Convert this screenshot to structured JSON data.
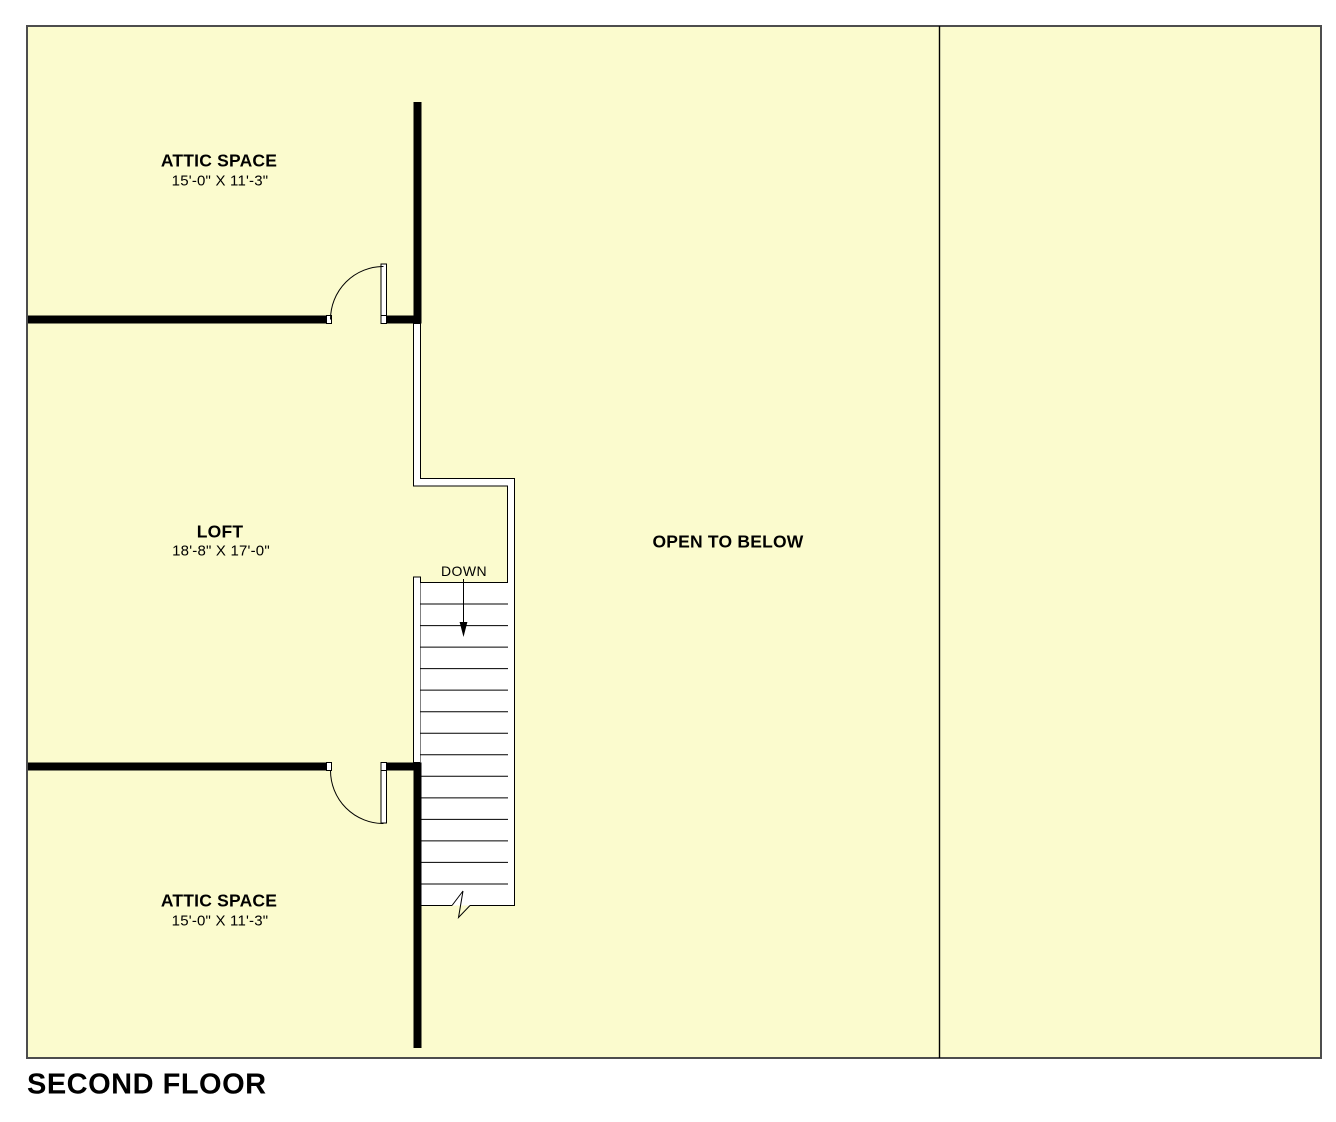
{
  "title": "SECOND FLOOR",
  "colors": {
    "page_bg": "#ffffff",
    "plan_fill": "#fbfbce",
    "wall": "#000000",
    "outline": "#4d4d4d"
  },
  "rooms": {
    "attic_top": {
      "name": "ATTIC SPACE",
      "dimensions": "15'-0\" X 11'-3\""
    },
    "loft": {
      "name": "LOFT",
      "dimensions": "18'-8\" X 17'-0\""
    },
    "open_to_below": {
      "name": "OPEN TO BELOW"
    },
    "attic_bottom": {
      "name": "ATTIC SPACE",
      "dimensions": "15'-0\" X 11'-3\""
    }
  },
  "stairs": {
    "label": "DOWN",
    "tread_count": 15
  }
}
